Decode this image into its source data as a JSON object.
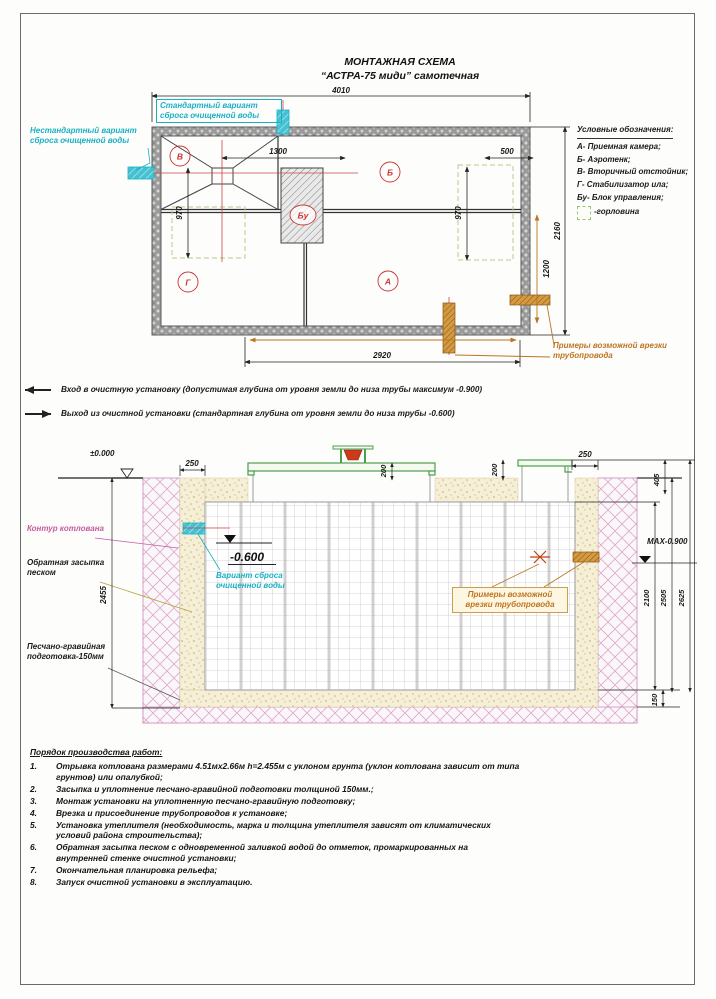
{
  "title": {
    "line1": "МОНТАЖНАЯ СХЕМА",
    "line2": "“АСТРА-75 миди” самотечная"
  },
  "legend": {
    "title": "Условные обозначения:",
    "items": [
      "А- Приемная камера;",
      "Б- Аэротенк;",
      "В- Вторичный отстойник;",
      "Г- Стабилизатор ила;",
      "Бу- Блок управления;"
    ],
    "gorlovina": "-горловина"
  },
  "plan": {
    "labels": {
      "standard": "Стандартный вариант сброса очищенной воды",
      "nonstandard": "Нестандартный вариант сброса очищенной воды",
      "pipe_examples": "Примеры возможной врезки трубопровода"
    },
    "letters": {
      "v": "В",
      "b": "Б",
      "bu": "Бу",
      "g": "Г",
      "a": "А"
    },
    "dims": {
      "w4010": "4010",
      "d1300": "1300",
      "d500": "500",
      "l970": "970",
      "r970": "970",
      "h2160": "2160",
      "p1200": "1200",
      "b2920": "2920"
    }
  },
  "notes": [
    {
      "text": "Вход в очистную установку (допустимая глубина от уровня земли до низа трубы максимум -0.900)"
    },
    {
      "text": "Выход из очистной установки (стандартная глубина от уровня земли до низа трубы -0.600)"
    }
  ],
  "section": {
    "levels": {
      "zero": "±0.000",
      "minus600": "-0.600",
      "max900": "МАХ-0.900"
    },
    "dims": {
      "l250": "250",
      "n200a": "200",
      "n200b": "200",
      "r250": "250",
      "r405": "405",
      "d2455": "2455",
      "d2100": "2100",
      "d2505": "2505",
      "d2625": "2625",
      "d150": "150"
    },
    "labels": {
      "kontur": "Контур котлована",
      "zasypka": "Обратная засыпка песком",
      "podgotovka": "Песчано-гравийная подготовка-150мм",
      "variant": "Вариант сброса очищенной воды",
      "pipe_examples": "Примеры возможной врезки трубопровода"
    }
  },
  "work": {
    "title": "Порядок производства работ:",
    "items": [
      {
        "n": "1.",
        "t": "Отрывка котлована размерами 4.51мх2.66м h=2.455м с уклоном грунта (уклон котлована зависит от типа грунтов) или опалубкой;"
      },
      {
        "n": "2.",
        "t": "Засыпка и уплотнение песчано-гравийной подготовки толщиной 150мм.;"
      },
      {
        "n": "3.",
        "t": "Монтаж установки на уплотненную песчано-гравийную подготовку;"
      },
      {
        "n": "4.",
        "t": "Врезка и присоединение трубопроводов к установке;"
      },
      {
        "n": "5.",
        "t": "Установка утеплителя (необходимость, марка и толщина утеплителя зависят от климатических условий района строительства);"
      },
      {
        "n": "6.",
        "t": "Обратная засыпка песком с одновременной заливкой водой до отметок, промаркированных на внутренней стенке очистной установки;"
      },
      {
        "n": "7.",
        "t": "Окончательная планировка рельефа;"
      },
      {
        "n": "8.",
        "t": "Запуск очистной установки в эксплуатацию."
      }
    ]
  },
  "colors": {
    "cyan": "#17b0c4",
    "magenta": "#c75b9b",
    "orange": "#bd7420",
    "red": "#cc3333",
    "green": "#4d9e4d"
  }
}
